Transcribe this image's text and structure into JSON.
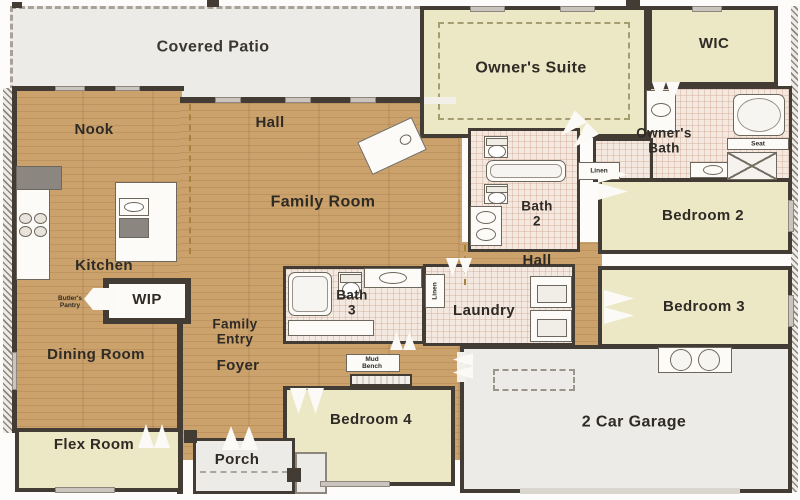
{
  "plan_title": "Single-story home floor plan",
  "rooms": {
    "covered_patio": "Covered Patio",
    "nook": "Nook",
    "hall_top": "Hall",
    "owners_suite": "Owner's Suite",
    "wic": "WIC",
    "owners_bath": "Owner's\nBath",
    "family_room": "Family Room",
    "kitchen": "Kitchen",
    "bath_2": "Bath\n2",
    "bedroom_2": "Bedroom 2",
    "hall_right": "Hall",
    "wip": "WIP",
    "dining_room": "Dining Room",
    "family_entry": "Family\nEntry",
    "foyer": "Foyer",
    "bath_3": "Bath\n3",
    "laundry": "Laundry",
    "bedroom_3": "Bedroom 3",
    "bedroom_4": "Bedroom 4",
    "flex_room": "Flex Room",
    "porch": "Porch",
    "garage": "2 Car Garage"
  },
  "annotations": {
    "butlers_pantry": "Butler's\nPantry",
    "mud_bench": "Mud\nBench",
    "linen_laundry": "Linen",
    "linen_hall": "Linen",
    "seat": "Seat"
  },
  "colors": {
    "wood_floor": "#cba26c",
    "bedroom_floor": "#ece7c4",
    "bath_tile": "#f4e9e1",
    "concrete": "#edebe7",
    "wall": "#423c34",
    "label_text": "#2e2a25"
  },
  "fixtures": {
    "bathtub": "rounded-rect-shape",
    "toilet": "tank-and-bowl-shape",
    "sink": "oval-shape",
    "shower": "x-pattern-square",
    "washer_dryer": "stacked-squares-with-door",
    "cooktop": "four-burner-circles",
    "refrigerator": "dark-rect",
    "kitchen_island": "rect-with-sink-and-dishwasher",
    "fireplace": "diagonal-corner-rect",
    "water_heater_pair": "twin-circles",
    "attic_access": "dashed-rect",
    "door_swing": "zigzag-white-triangles"
  }
}
